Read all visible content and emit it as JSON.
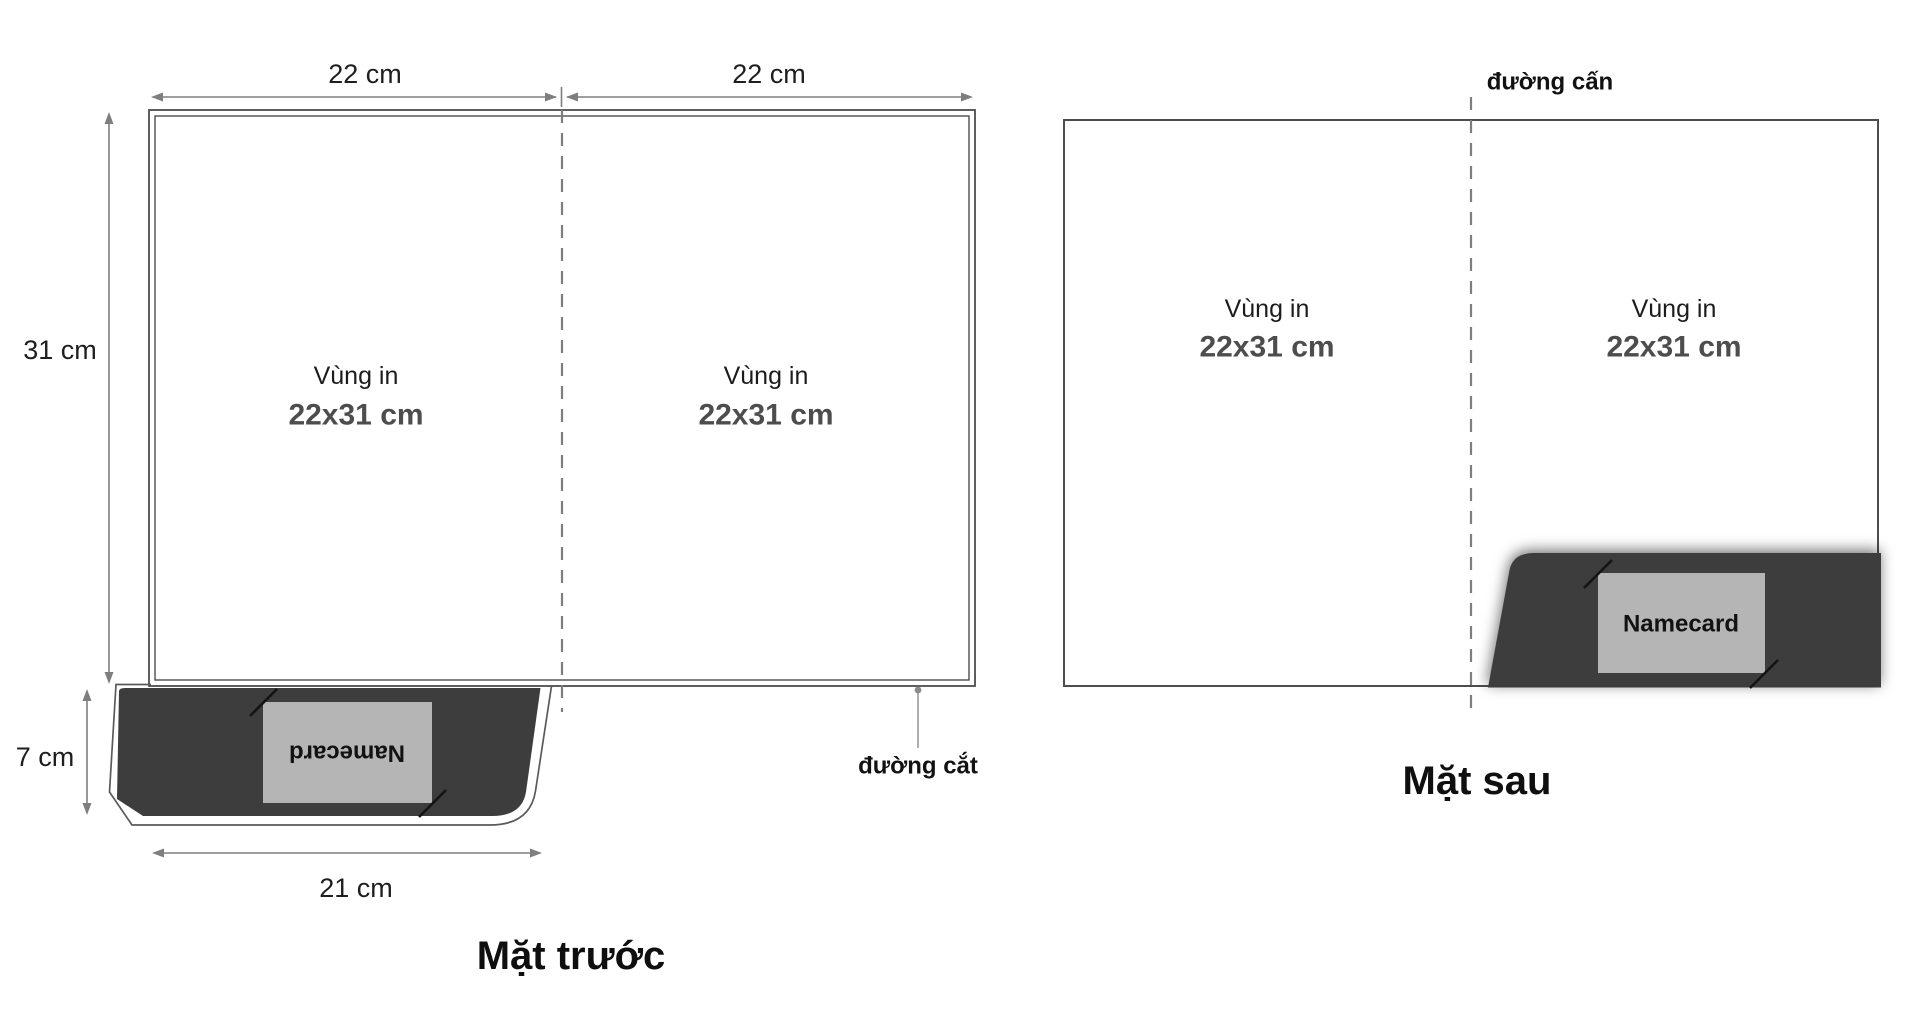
{
  "figure": {
    "description": "Folder dieline template, front and back sides",
    "front": {
      "title": "Mặt trước",
      "dim_top_left": "22 cm",
      "dim_top_right": "22 cm",
      "dim_height": "31 cm",
      "dim_pocket_height": "7 cm",
      "dim_pocket_width": "21 cm",
      "panels": {
        "left": {
          "line1": "Vùng in",
          "line2": "22x31 cm"
        },
        "right": {
          "line1": "Vùng in",
          "line2": "22x31 cm"
        }
      },
      "pocket": {
        "card_label": "Namecard"
      },
      "cut_label": "đường cắt"
    },
    "back": {
      "title": "Mặt sau",
      "crease_label": "đường cấn",
      "panels": {
        "left": {
          "line1": "Vùng in",
          "line2": "22x31 cm"
        },
        "right": {
          "line1": "Vùng in",
          "line2": "22x31 cm"
        }
      },
      "pocket": {
        "card_label": "Namecard"
      }
    },
    "colors": {
      "pocket_fill": "#3d3d3d",
      "card_fill": "#b5b5b5",
      "outline_gray": "#4d4d4d",
      "dimension_gray": "#7e7e7e"
    }
  }
}
